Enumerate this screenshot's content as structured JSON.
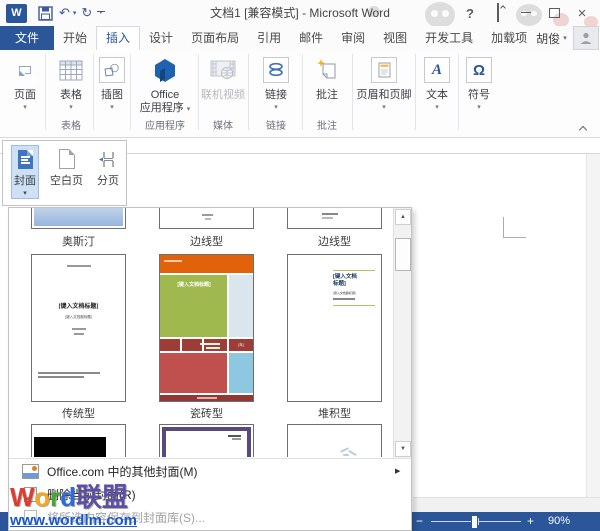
{
  "window": {
    "title": "文档1 [兼容模式] - Microsoft Word",
    "app_logo": "W"
  },
  "icons": {
    "caret_down": "▾",
    "scroll_up": "▲",
    "scroll_down": "▼",
    "submenu_arrow": "▶",
    "help": "?",
    "close": "×",
    "undo": "↶",
    "redo": "↻",
    "zoom_out": "−",
    "zoom_in": "+",
    "omega": "Ω",
    "letter_a": "A"
  },
  "tabs": [
    {
      "label": "文件"
    },
    {
      "label": "开始"
    },
    {
      "label": "插入"
    },
    {
      "label": "设计"
    },
    {
      "label": "页面布局"
    },
    {
      "label": "引用"
    },
    {
      "label": "邮件"
    },
    {
      "label": "审阅"
    },
    {
      "label": "视图"
    },
    {
      "label": "开发工具"
    },
    {
      "label": "加载项"
    }
  ],
  "user": {
    "name": "胡俊"
  },
  "ribbon": {
    "pages_button": "页面",
    "table_button": "表格",
    "table_group": "表格",
    "illustrations_button": "插图",
    "office_line1": "Office",
    "office_line2": "应用程序",
    "apps_group": "应用程序",
    "video_button": "联机视频",
    "media_group": "媒体",
    "links_button": "链接",
    "links_group": "链接",
    "comment_button": "批注",
    "comment_group": "批注",
    "header_footer_button": "页眉和页脚",
    "text_button": "文本",
    "symbol_button": "符号"
  },
  "pages_menu": {
    "cover": "封面",
    "blank": "空白页",
    "break": "分页"
  },
  "gallery": {
    "row1_labels": [
      "奥斯汀",
      "边线型",
      "边线型"
    ],
    "row2_labels": [
      "传统型",
      "瓷砖型",
      "堆积型"
    ],
    "covers": {
      "traditional": {
        "title": "[键入文档标题]",
        "subtitle": "[键入文档副标题]"
      },
      "tile": {
        "title": "[键入文档标题]",
        "year": "[年]"
      },
      "stacked": {
        "title_line1": "[键入文档",
        "title_line2": "标题]",
        "subtitle": "[键入文档副标题]"
      }
    }
  },
  "menu": {
    "more_covers": "Office.com 中的其他封面(M)",
    "remove_cover": "删除当前封面(R)",
    "save_selection": "将所选内容保存到封面库(S)..."
  },
  "status": {
    "zoom_level": "90%"
  },
  "watermark": {
    "letters": [
      {
        "ch": "W",
        "style": "color:#e23b2e"
      },
      {
        "ch": "o",
        "style": "color:#f6a71f"
      },
      {
        "ch": "r",
        "style": "color:#3faa36"
      },
      {
        "ch": "d",
        "style": "color:#2f6bd4"
      },
      {
        "ch": "联盟",
        "style": "color:#5c50a5"
      }
    ],
    "url": "www.wordlm.com"
  },
  "colors": {
    "accent": "#2b579a"
  }
}
